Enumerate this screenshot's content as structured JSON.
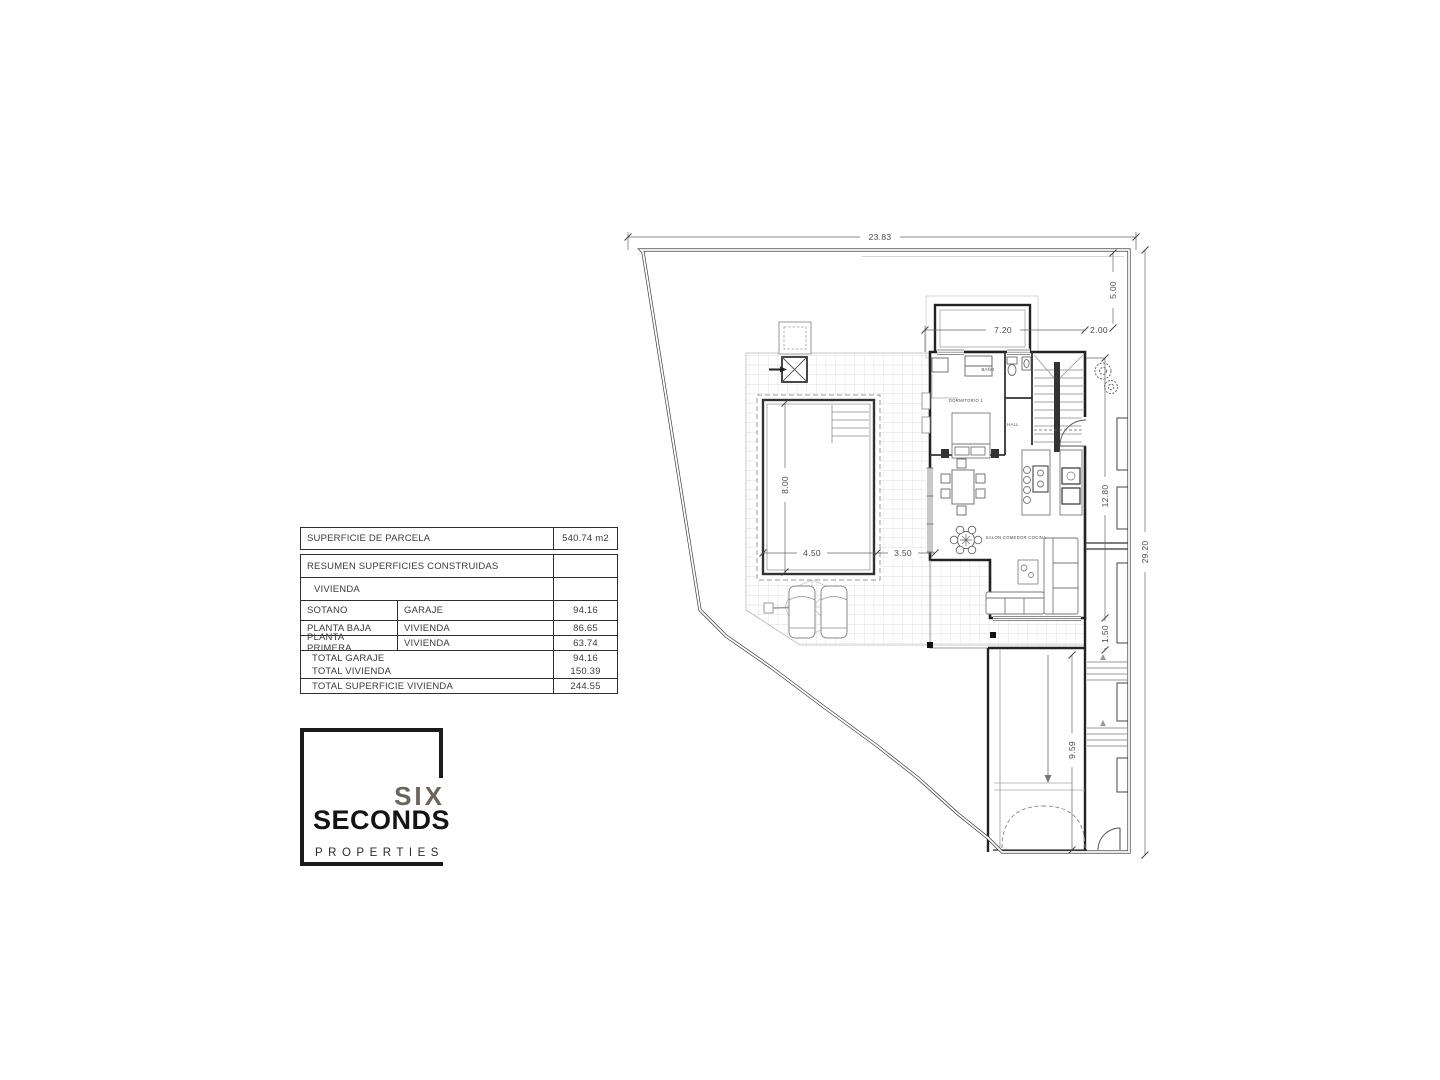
{
  "area_table": {
    "parcel_row": {
      "label": "SUPERFICIE DE PARCELA",
      "value": "540.74 m2"
    },
    "summary_header": "RESUMEN SUPERFICIES CONSTRUIDAS",
    "group_header": "VIVIENDA",
    "rows": [
      {
        "col1": "SOTANO",
        "col2": "GARAJE",
        "value": "94.16"
      },
      {
        "col1": "PLANTA BAJA",
        "col2": "VIVIENDA",
        "value": "86.65"
      },
      {
        "col1": "PLANTA PRIMERA",
        "col2": "VIVIENDA",
        "value": "63.74"
      }
    ],
    "totals": [
      {
        "label": "TOTAL GARAJE",
        "value": "94.16"
      },
      {
        "label": "TOTAL VIVIENDA",
        "value": "150.39"
      }
    ],
    "grand_total": {
      "label": "TOTAL SUPERFICIE VIVIENDA",
      "value": "244.55"
    }
  },
  "logo": {
    "word1": "SIX",
    "word2": "SECONDS",
    "word3": "PROPERTIES"
  },
  "plan": {
    "dimensions": {
      "plot_width": "23.83",
      "plot_height": "29.20",
      "setback_top": "5.00",
      "setback_right": "2.00",
      "house_width": "7.20",
      "house_depth": "12.80",
      "gap_south": "1.50",
      "driveway_length": "9.59",
      "pool_length": "8.00",
      "pool_width": "4.50",
      "pool_to_house": "3.50"
    },
    "room_labels": {
      "bedroom": "DORMITORIO 1",
      "bath": "BAÑO",
      "hall": "HALL",
      "living": "SALON COMEDOR COCINA"
    }
  },
  "colors": {
    "wall": "#222222",
    "boundary": "#3d3d3d",
    "table_border": "#2e2e2e",
    "dim_text": "#4a4a4a"
  }
}
